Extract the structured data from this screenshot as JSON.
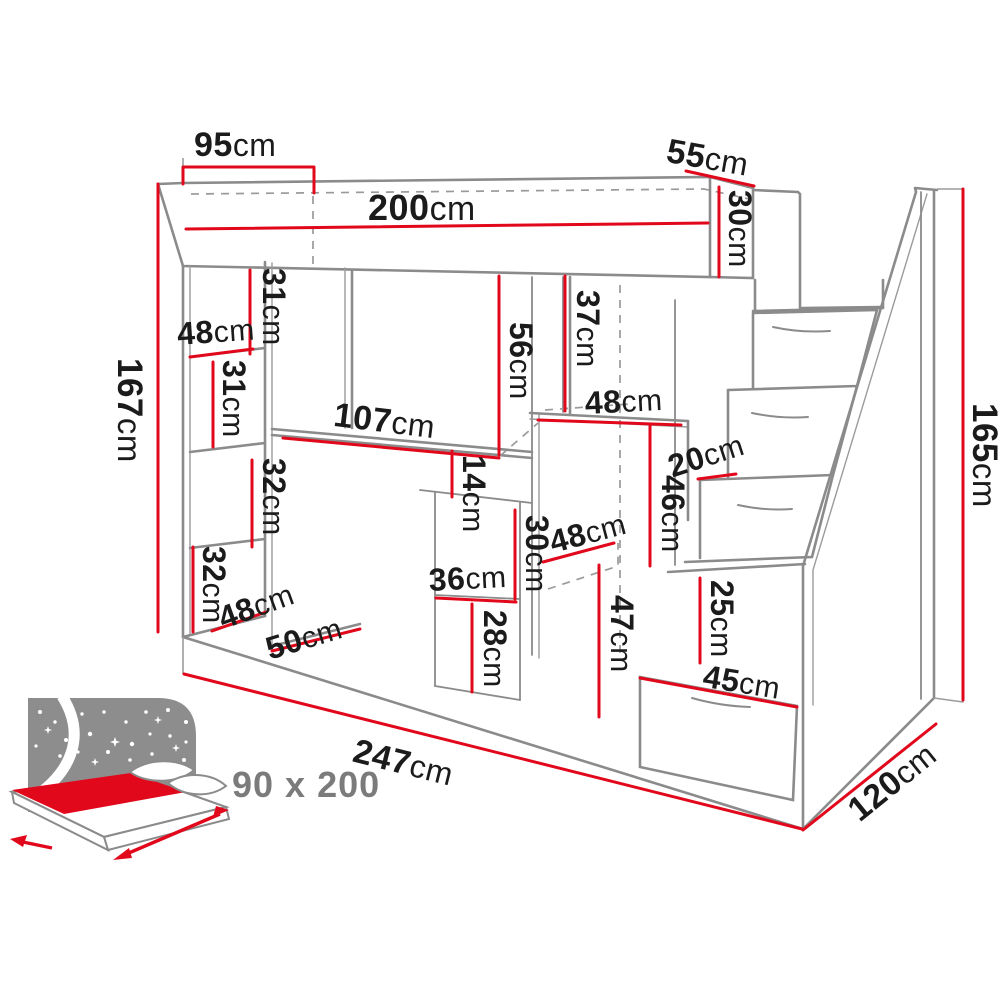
{
  "diagram": {
    "title": "Loft bed with desk, shelves, wardrobe and stair drawers — dimensional drawing",
    "unit": "cm",
    "colors": {
      "dimension_red": "#e2081c",
      "structure_gray": "#8b8b8b",
      "text_black": "#1b1b1b",
      "icon_gray": "#8d8d8d"
    },
    "bed_icon": {
      "size_label": "90 x 200"
    }
  },
  "dimensions": [
    {
      "id": "bed-top-overhang",
      "value": "95",
      "unit": "cm"
    },
    {
      "id": "bed-length",
      "value": "200",
      "unit": "cm"
    },
    {
      "id": "bed-head-depth",
      "value": "55",
      "unit": "cm"
    },
    {
      "id": "bed-frame-height",
      "value": "30",
      "unit": "cm"
    },
    {
      "id": "left-total-height",
      "value": "167",
      "unit": "cm"
    },
    {
      "id": "upper-shelf-space",
      "value": "31",
      "unit": "cm"
    },
    {
      "id": "shelf-width-top",
      "value": "48",
      "unit": "cm"
    },
    {
      "id": "shelf-compartment-1",
      "value": "31",
      "unit": "cm"
    },
    {
      "id": "shelf-compartment-2",
      "value": "32",
      "unit": "cm"
    },
    {
      "id": "shelf-compartment-3",
      "value": "32",
      "unit": "cm"
    },
    {
      "id": "shelf-width-bottom",
      "value": "48",
      "unit": "cm"
    },
    {
      "id": "shelf-depth",
      "value": "50",
      "unit": "cm"
    },
    {
      "id": "desk-width",
      "value": "107",
      "unit": "cm"
    },
    {
      "id": "desk-clearance-height",
      "value": "56",
      "unit": "cm"
    },
    {
      "id": "upper-right-space",
      "value": "37",
      "unit": "cm"
    },
    {
      "id": "wardrobe-top-width",
      "value": "48",
      "unit": "cm"
    },
    {
      "id": "under-desk-gap",
      "value": "14",
      "unit": "cm"
    },
    {
      "id": "middle-niche-height",
      "value": "30",
      "unit": "cm"
    },
    {
      "id": "under-desk-drawer",
      "value": "36",
      "unit": "cm"
    },
    {
      "id": "under-desk-lower",
      "value": "28",
      "unit": "cm"
    },
    {
      "id": "wardrobe-bottom-width",
      "value": "48",
      "unit": "cm"
    },
    {
      "id": "wardrobe-lower-height",
      "value": "47",
      "unit": "cm"
    },
    {
      "id": "stairs-side-height",
      "value": "46",
      "unit": "cm"
    },
    {
      "id": "step-depth",
      "value": "20",
      "unit": "cm"
    },
    {
      "id": "stair-drawer-height",
      "value": "25",
      "unit": "cm"
    },
    {
      "id": "stair-drawer-width",
      "value": "45",
      "unit": "cm"
    },
    {
      "id": "right-total-height",
      "value": "165",
      "unit": "cm"
    },
    {
      "id": "total-width",
      "value": "247",
      "unit": "cm"
    },
    {
      "id": "total-depth",
      "value": "120",
      "unit": "cm"
    }
  ]
}
